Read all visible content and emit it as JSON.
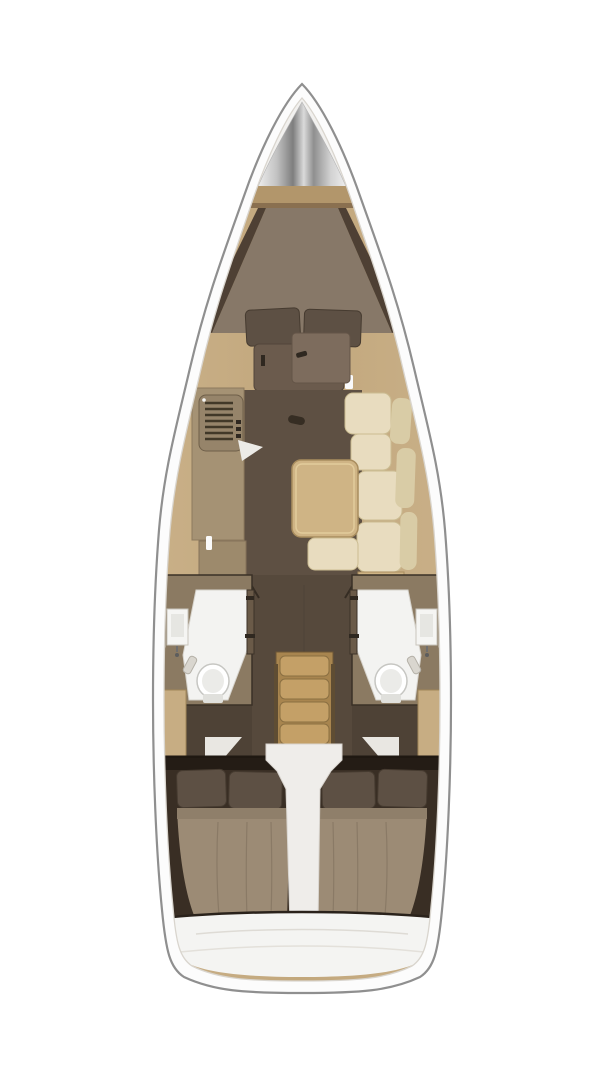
{
  "meta": {
    "kind": "sailboat-interior-floor-plan-top-view"
  },
  "regions": [
    "bow-anchor-locker",
    "forward-v-berth-cabin",
    "saloon",
    "galley",
    "chart-table",
    "l-settee",
    "saloon-table",
    "heads-port",
    "heads-starboard",
    "companionway-steps",
    "aft-cabin-port",
    "aft-cabin-starboard",
    "stern-transom"
  ],
  "palette": {
    "background": "#ffffff",
    "hull_band": "#fcfcfc",
    "hull_outline": "#8f8f8f",
    "inner_edge": "#d9d5ce",
    "wood_base": "#c7ad83",
    "wood_trim": "#b2966b",
    "wood_trim_shadow": "#8a7050",
    "bow_white": "#f2f1ef",
    "floor_dark": "#5e5043",
    "floor_corridor": "#56493c",
    "floor_wing": "#4e4236",
    "floor_fwd_dark": "#4e4034",
    "mattress": "#877868",
    "pillow": "#5d5044",
    "pillow_stroke": "#463b30",
    "dresser": "#6b5b4d",
    "chart_table": "#7d6c5d",
    "galley_counter": "#a59274",
    "stove_body": "#96846a",
    "stove_slat": "#413828",
    "galley_block": "#9d8a6c",
    "cushion": "#e8dcbf",
    "cushion_dark": "#d9cca6",
    "table_wood": "#cfb485",
    "heads_wall": "#8b7a62",
    "heads_white": "#f3f3f1",
    "toilet": "#ffffff",
    "door": "#6a5a48",
    "hardware": "#2f2820",
    "steps_base": "#a8854f",
    "step_tread": "#c4a067",
    "platform": "#efedea",
    "aft_dark": "#392e24",
    "aft_darker": "#241c15",
    "duvet": "#9c8b75",
    "duvet_seam": "#8f7f6a",
    "transom": "#f4f4f2",
    "accent_white": "#fafafa",
    "wedge_white": "#e9e7e2"
  }
}
